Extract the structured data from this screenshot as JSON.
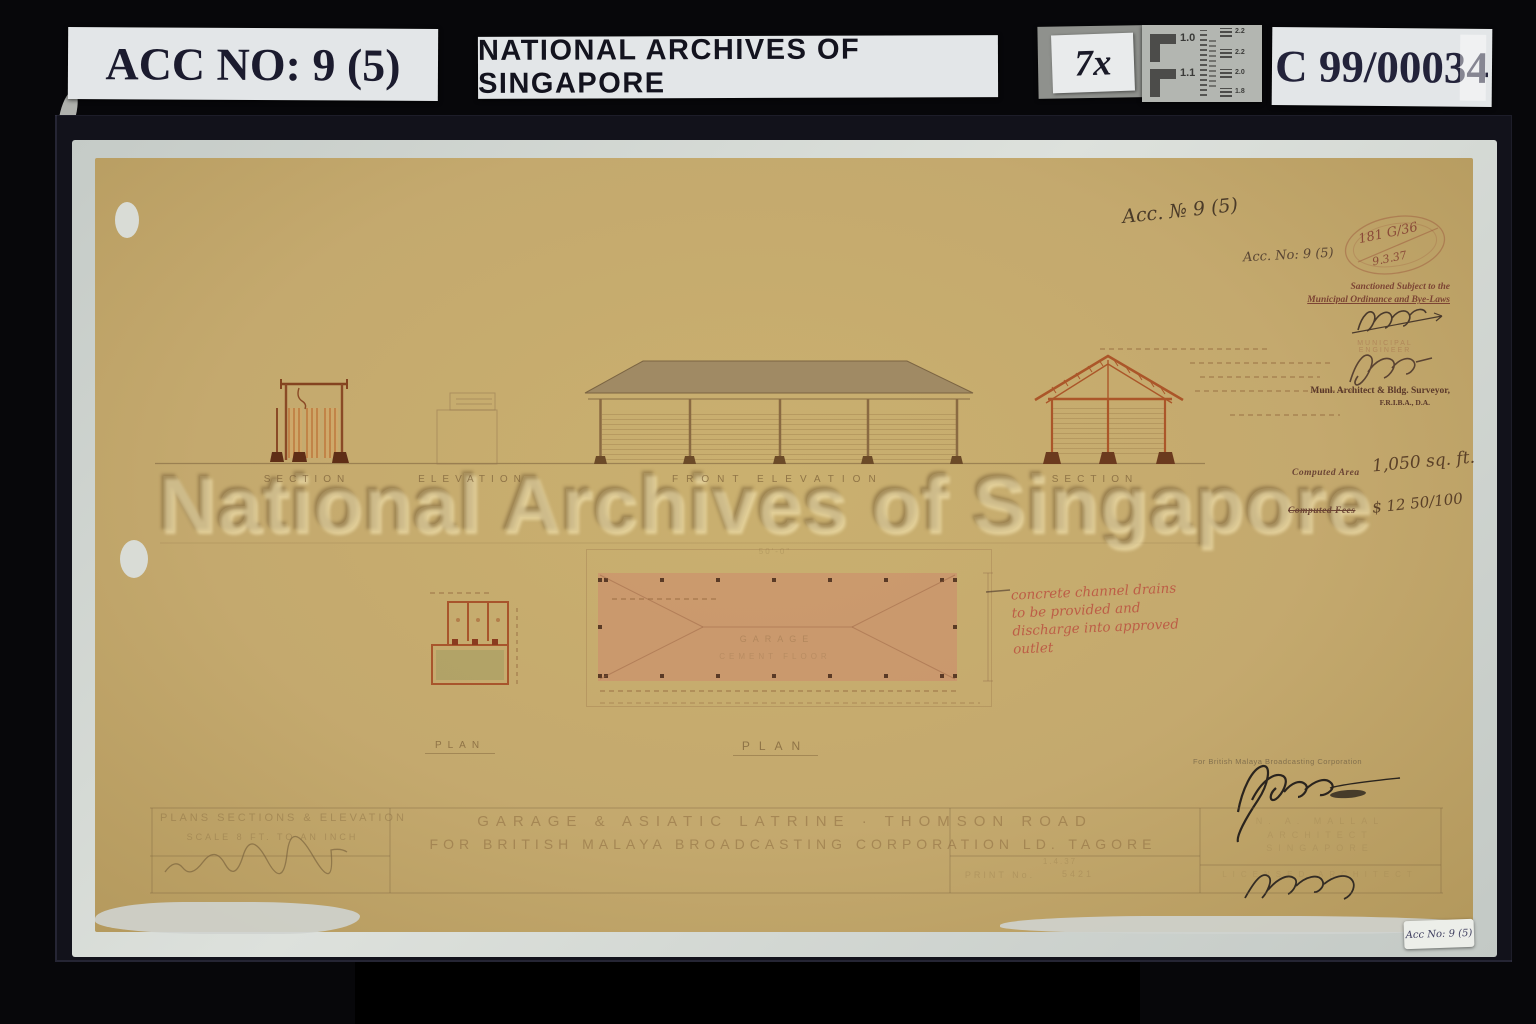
{
  "header": {
    "acc_label": "ACC NO: 9 (5)",
    "archive_label": "NATIONAL ARCHIVES OF SINGAPORE",
    "magnification": "7x",
    "ref_label": "C 99/00034",
    "test_chart": {
      "left_values": [
        "1.0",
        "1.1"
      ],
      "right_values": [
        "2.2",
        "2.2",
        "2.0",
        "1.8"
      ]
    }
  },
  "watermark": "National Archives of Singapore",
  "annotations": {
    "acc_no_large": "Acc. № 9 (5)",
    "acc_no_small": "Acc. No: 9 (5)",
    "stamp_number": "181 G/36",
    "stamp_date": "9.3.37",
    "sanction_line1": "Sanctioned Subject to the",
    "sanction_line2": "Municipal Ordinance and Bye-Laws",
    "municipal_stamp": "MUNICIPAL ENGINEER",
    "surveyor_line1": "Munl. Architect & Bldg. Surveyor,",
    "surveyor_line2": "F.R.I.B.A., D.A.",
    "computed_area_label": "Computed Area",
    "computed_area_value": "1,050 sq. ft.",
    "computed_fees_label": "Computed Fees",
    "computed_fees_value": "$ 12 50/100",
    "red_note_line1": "concrete channel drains",
    "red_note_line2": "to be provided and",
    "red_note_line3": "discharge into approved",
    "red_note_line4": "outlet",
    "broadcasting_stamp": "For British Malaya Broadcasting Corporation",
    "sticker": "Acc No: 9 (5)"
  },
  "drawing_labels": {
    "section_left": "SECTION",
    "elevation": "ELEVATION",
    "front_elevation": "FRONT ELEVATION",
    "section_right": "SECTION",
    "plan_small": "PLAN",
    "plan_large": "PLAN",
    "garage": "GARAGE",
    "cement_floor": "CEMENT FLOOR",
    "dim_width": "50'-0\""
  },
  "title_block": {
    "left_line1": "PLANS SECTIONS & ELEVATION",
    "left_line2": "SCALE 8 FT. TO AN INCH",
    "title_line1": "GARAGE & ASIATIC LATRINE · THOMSON ROAD",
    "title_line2": "FOR BRITISH MALAYA BROADCASTING CORPORATION LD. TAGORE",
    "date_value": "1.4.37",
    "print_label": "PRINT No.",
    "print_value": "5421",
    "architect_line1": "N. A. MALLAL",
    "architect_line2": "ARCHITECT",
    "architect_line3": "SINGAPORE",
    "architect_line4": "LICENSED ARCHITECT"
  },
  "colors": {
    "mat": "#12121b",
    "paper": "#c4a96e",
    "backing": "#d5dad6",
    "drafting_ink": "#7a5e37",
    "section_ink": "#b05a2a",
    "red_ink": "#ba4a3c",
    "label_background": "#e3e6e8",
    "label_text": "#1b1b2e"
  }
}
